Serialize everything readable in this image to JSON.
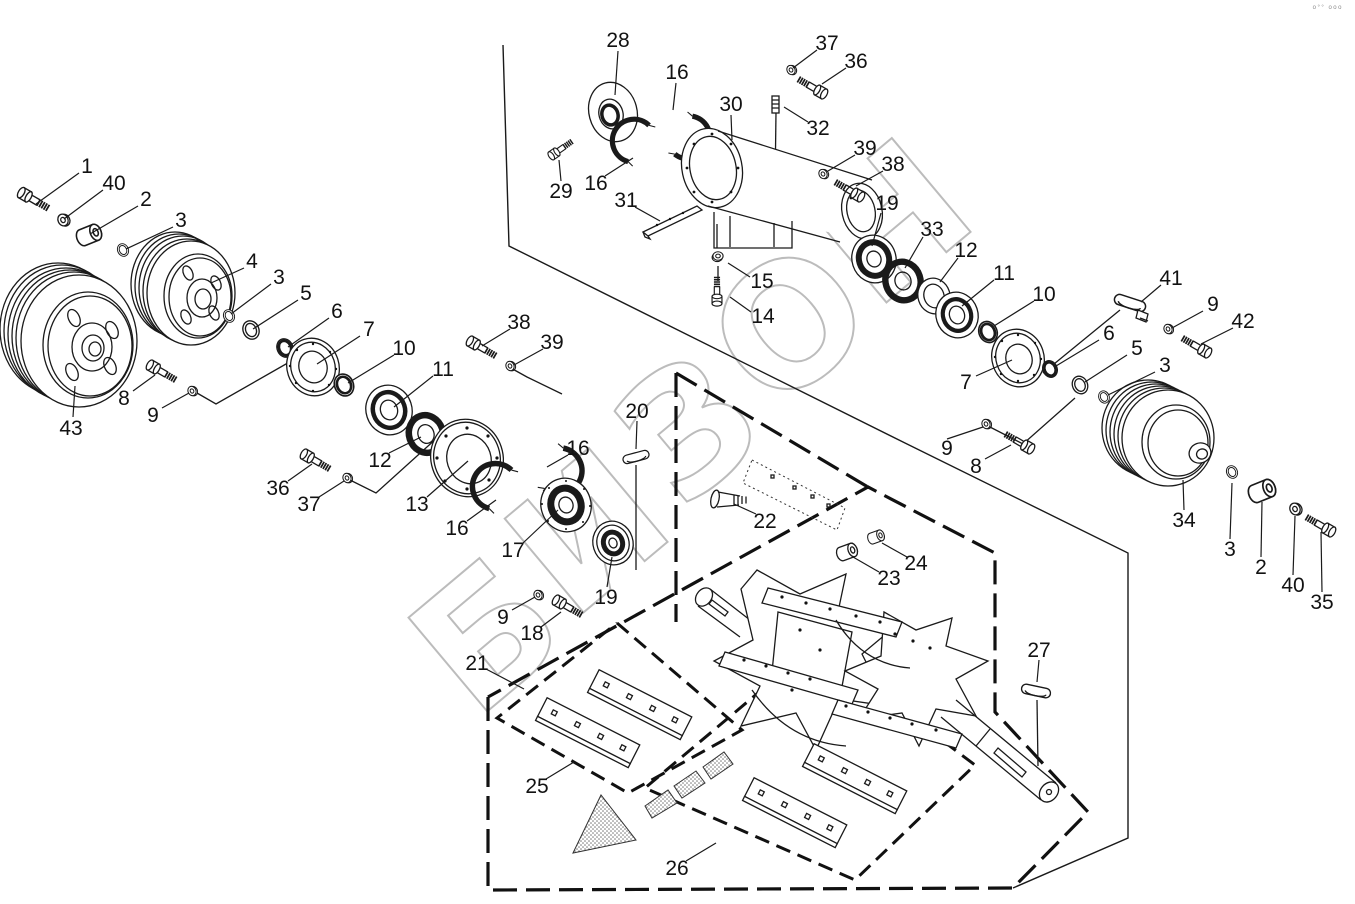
{
  "meta": {
    "background": "#ffffff",
    "line_color": "#1a1a1a",
    "watermark_color": "#bcbcbc",
    "diagram_type": "exploded-parts-view"
  },
  "corner_mark": "о°° ооо",
  "watermark": {
    "text": "БИЗОН",
    "rotate": -40,
    "letters": [
      {
        "ch": "Б",
        "x": 495,
        "y": 645
      },
      {
        "ch": "И",
        "x": 596,
        "y": 542
      },
      {
        "ch": "З",
        "x": 697,
        "y": 438
      },
      {
        "ch": "О",
        "x": 798,
        "y": 335
      },
      {
        "ch": "Н",
        "x": 899,
        "y": 232
      }
    ]
  },
  "labels": [
    {
      "t": "1",
      "x": 87,
      "y": 166,
      "l": [
        79,
        173,
        36,
        204
      ]
    },
    {
      "t": "40",
      "x": 114,
      "y": 183,
      "l": [
        103,
        190,
        64,
        219
      ]
    },
    {
      "t": "2",
      "x": 146,
      "y": 199,
      "l": [
        138,
        206,
        90,
        234
      ]
    },
    {
      "t": "3",
      "x": 181,
      "y": 220,
      "l": [
        173,
        227,
        126,
        249
      ]
    },
    {
      "t": "4",
      "x": 252,
      "y": 261,
      "l": [
        244,
        268,
        211,
        283
      ]
    },
    {
      "t": "3",
      "x": 279,
      "y": 277,
      "l": [
        271,
        284,
        231,
        314
      ]
    },
    {
      "t": "5",
      "x": 306,
      "y": 293,
      "l": [
        298,
        300,
        253,
        329
      ]
    },
    {
      "t": "6",
      "x": 337,
      "y": 311,
      "l": [
        329,
        318,
        288,
        347
      ]
    },
    {
      "t": "7",
      "x": 369,
      "y": 329,
      "l": [
        360,
        336,
        317,
        364
      ]
    },
    {
      "t": "10",
      "x": 404,
      "y": 348,
      "l": [
        394,
        355,
        348,
        383
      ]
    },
    {
      "t": "11",
      "x": 443,
      "y": 369,
      "l": [
        433,
        376,
        394,
        407
      ]
    },
    {
      "t": "12",
      "x": 380,
      "y": 460,
      "l": [
        389,
        453,
        421,
        437
      ]
    },
    {
      "t": "13",
      "x": 417,
      "y": 504,
      "l": [
        427,
        497,
        468,
        461
      ]
    },
    {
      "t": "16",
      "x": 457,
      "y": 528,
      "l": [
        467,
        521,
        496,
        500
      ]
    },
    {
      "t": "16",
      "x": 578,
      "y": 448,
      "l": [
        568,
        455,
        547,
        467
      ]
    },
    {
      "t": "17",
      "x": 513,
      "y": 550,
      "l": [
        523,
        543,
        558,
        510
      ]
    },
    {
      "t": "19",
      "x": 606,
      "y": 597,
      "l": [
        607,
        587,
        612,
        557
      ]
    },
    {
      "t": "36",
      "x": 278,
      "y": 488,
      "l": [
        288,
        481,
        312,
        464
      ]
    },
    {
      "t": "37",
      "x": 309,
      "y": 504,
      "l": [
        319,
        497,
        344,
        481
      ]
    },
    {
      "t": "38",
      "x": 519,
      "y": 322,
      "l": [
        510,
        329,
        482,
        346
      ]
    },
    {
      "t": "39",
      "x": 552,
      "y": 342,
      "l": [
        543,
        349,
        514,
        365
      ]
    },
    {
      "t": "8",
      "x": 124,
      "y": 398,
      "l": [
        133,
        391,
        155,
        375
      ]
    },
    {
      "t": "9",
      "x": 153,
      "y": 415,
      "l": [
        162,
        408,
        189,
        393
      ]
    },
    {
      "t": "43",
      "x": 71,
      "y": 428,
      "l": [
        73,
        417,
        75,
        386
      ]
    },
    {
      "t": "28",
      "x": 618,
      "y": 40,
      "l": [
        618,
        51,
        615,
        95
      ]
    },
    {
      "t": "16",
      "x": 677,
      "y": 72,
      "l": [
        676,
        83,
        673,
        110
      ]
    },
    {
      "t": "29",
      "x": 561,
      "y": 191,
      "l": [
        561,
        181,
        559,
        160
      ]
    },
    {
      "t": "16",
      "x": 596,
      "y": 183,
      "l": [
        605,
        176,
        633,
        158
      ]
    },
    {
      "t": "31",
      "x": 626,
      "y": 200,
      "l": [
        635,
        207,
        660,
        221
      ]
    },
    {
      "t": "30",
      "x": 731,
      "y": 104,
      "l": [
        731,
        115,
        732,
        140
      ]
    },
    {
      "t": "15",
      "x": 762,
      "y": 281,
      "l": [
        750,
        277,
        728,
        263
      ]
    },
    {
      "t": "14",
      "x": 763,
      "y": 316,
      "l": [
        751,
        312,
        730,
        297
      ]
    },
    {
      "t": "37",
      "x": 827,
      "y": 43,
      "l": [
        817,
        50,
        793,
        68
      ]
    },
    {
      "t": "36",
      "x": 856,
      "y": 61,
      "l": [
        846,
        68,
        822,
        84
      ]
    },
    {
      "t": "32",
      "x": 818,
      "y": 128,
      "l": [
        808,
        122,
        784,
        107
      ]
    },
    {
      "t": "39",
      "x": 865,
      "y": 148,
      "l": [
        855,
        155,
        828,
        171
      ]
    },
    {
      "t": "38",
      "x": 893,
      "y": 164,
      "l": [
        883,
        171,
        856,
        186
      ]
    },
    {
      "t": "19",
      "x": 887,
      "y": 203,
      "l": [
        881,
        213,
        872,
        246
      ]
    },
    {
      "t": "33",
      "x": 932,
      "y": 229,
      "l": [
        923,
        237,
        905,
        268
      ]
    },
    {
      "t": "12",
      "x": 966,
      "y": 250,
      "l": [
        958,
        258,
        940,
        282
      ]
    },
    {
      "t": "11",
      "x": 1004,
      "y": 273,
      "l": [
        994,
        280,
        962,
        306
      ]
    },
    {
      "t": "10",
      "x": 1044,
      "y": 294,
      "l": [
        1034,
        301,
        994,
        326
      ]
    },
    {
      "t": "7",
      "x": 966,
      "y": 382,
      "l": [
        976,
        376,
        1012,
        360
      ]
    },
    {
      "t": "6",
      "x": 1109,
      "y": 333,
      "l": [
        1099,
        340,
        1056,
        366
      ]
    },
    {
      "t": "5",
      "x": 1137,
      "y": 348,
      "l": [
        1127,
        355,
        1085,
        382
      ]
    },
    {
      "t": "3",
      "x": 1165,
      "y": 365,
      "l": [
        1155,
        372,
        1108,
        395
      ]
    },
    {
      "t": "41",
      "x": 1171,
      "y": 278,
      "l": [
        1161,
        285,
        1141,
        302
      ]
    },
    {
      "t": "9",
      "x": 1213,
      "y": 304,
      "l": [
        1203,
        311,
        1172,
        328
      ]
    },
    {
      "t": "42",
      "x": 1243,
      "y": 321,
      "l": [
        1233,
        328,
        1201,
        344
      ]
    },
    {
      "t": "9",
      "x": 947,
      "y": 448,
      "l": [
        947,
        439,
        983,
        427
      ]
    },
    {
      "t": "8",
      "x": 976,
      "y": 466,
      "l": [
        985,
        459,
        1011,
        445
      ]
    },
    {
      "t": "34",
      "x": 1184,
      "y": 520,
      "l": [
        1184,
        510,
        1183,
        480
      ]
    },
    {
      "t": "3",
      "x": 1230,
      "y": 549,
      "l": [
        1230,
        539,
        1232,
        483
      ]
    },
    {
      "t": "2",
      "x": 1261,
      "y": 567,
      "l": [
        1261,
        557,
        1262,
        502
      ]
    },
    {
      "t": "40",
      "x": 1293,
      "y": 585,
      "l": [
        1293,
        575,
        1295,
        516
      ]
    },
    {
      "t": "35",
      "x": 1322,
      "y": 602,
      "l": [
        1322,
        592,
        1321,
        532
      ]
    },
    {
      "t": "20",
      "x": 637,
      "y": 411,
      "l": [
        637,
        421,
        636,
        449
      ]
    },
    {
      "t": "22",
      "x": 765,
      "y": 521,
      "l": [
        756,
        514,
        734,
        504
      ]
    },
    {
      "t": "23",
      "x": 889,
      "y": 578,
      "l": [
        879,
        572,
        853,
        557
      ]
    },
    {
      "t": "24",
      "x": 916,
      "y": 563,
      "l": [
        907,
        557,
        882,
        543
      ]
    },
    {
      "t": "27",
      "x": 1039,
      "y": 650,
      "l": [
        1039,
        660,
        1037,
        682
      ]
    },
    {
      "t": "21",
      "x": 477,
      "y": 663,
      "l": [
        486,
        669,
        524,
        689
      ]
    },
    {
      "t": "18",
      "x": 532,
      "y": 633,
      "l": [
        541,
        627,
        561,
        612
      ]
    },
    {
      "t": "9",
      "x": 503,
      "y": 617,
      "l": [
        512,
        610,
        535,
        597
      ]
    },
    {
      "t": "25",
      "x": 537,
      "y": 786,
      "l": [
        546,
        779,
        574,
        762
      ]
    },
    {
      "t": "26",
      "x": 677,
      "y": 868,
      "l": [
        686,
        861,
        716,
        843
      ]
    }
  ],
  "connectors": [
    {
      "points": [
        [
          197,
          393
        ],
        [
          216,
          404
        ],
        [
          300,
          356
        ]
      ]
    },
    {
      "points": [
        [
          350,
          480
        ],
        [
          376,
          493
        ],
        [
          448,
          428
        ]
      ]
    },
    {
      "points": [
        [
          509,
          367
        ],
        [
          527,
          377
        ],
        [
          562,
          394
        ]
      ]
    },
    {
      "points": [
        [
          988,
          426
        ],
        [
          1023,
          444
        ],
        [
          1075,
          398
        ]
      ]
    },
    {
      "points": [
        [
          1120,
          310
        ],
        [
          1043,
          373
        ]
      ]
    },
    {
      "points": [
        [
          776,
          112
        ],
        [
          775,
          190
        ]
      ]
    },
    {
      "points": [
        [
          636,
          465
        ],
        [
          636,
          570
        ]
      ]
    },
    {
      "points": [
        [
          1037,
          700
        ],
        [
          1038,
          766
        ]
      ]
    },
    {
      "points": [
        [
          717,
          224
        ],
        [
          717,
          248
        ]
      ]
    },
    {
      "points": [
        [
          718,
          266
        ],
        [
          718,
          281
        ]
      ]
    }
  ],
  "boundaries": [
    {
      "style": "solid",
      "points": [
        [
          503,
          45
        ],
        [
          509,
          246
        ],
        [
          905,
          443
        ],
        [
          1128,
          553
        ],
        [
          1128,
          838
        ],
        [
          1013,
          888
        ]
      ]
    },
    {
      "style": "dash",
      "points": [
        [
          488,
          697
        ],
        [
          488,
          890
        ],
        [
          1013,
          888
        ],
        [
          1088,
          812
        ],
        [
          995,
          712
        ],
        [
          995,
          553
        ],
        [
          868,
          487
        ],
        [
          488,
          697
        ]
      ]
    },
    {
      "style": "dash",
      "points": [
        [
          676,
          373
        ],
        [
          676,
          622
        ]
      ]
    },
    {
      "style": "dash",
      "points": [
        [
          676,
          373
        ],
        [
          868,
          487
        ]
      ]
    },
    {
      "style": "rhombus",
      "points": [
        [
          617,
          623
        ],
        [
          742,
          730
        ],
        [
          628,
          793
        ],
        [
          497,
          718
        ],
        [
          617,
          623
        ]
      ]
    },
    {
      "style": "rhombus",
      "points": [
        [
          815,
          645
        ],
        [
          975,
          765
        ],
        [
          855,
          880
        ],
        [
          645,
          788
        ],
        [
          815,
          645
        ]
      ]
    }
  ]
}
